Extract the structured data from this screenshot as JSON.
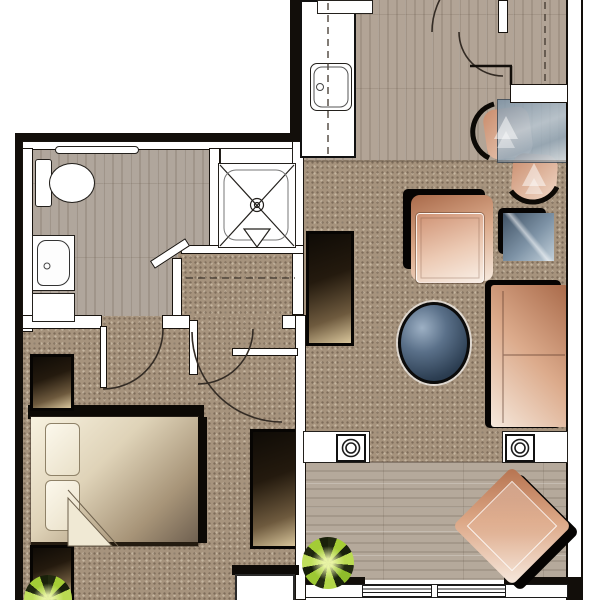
{
  "title": "One-bedroom apartment floor plan (rendered, no text labels)",
  "palette": {
    "carpet": "#a6937d",
    "wood_entry": "#b2a496",
    "wood_bathroom": "#b0a69c",
    "wood_sunroom": "#b5a99b",
    "wall_black": "#120e0a",
    "wall_white": "#ffffff",
    "upholstery_salmon_dark": "#a96a4a",
    "upholstery_salmon_light": "#f6e9dd",
    "glass_blue_dark": "#3f5164",
    "glass_blue_light": "#c2d0da",
    "coffee_table_slate": "#2c3e52",
    "bed_cream": "#f8f2e0",
    "bed_brown": "#6f6050",
    "dark_wood": "#241a0e",
    "plant_green": "#a5ce35",
    "plant_dark": "#1a230c"
  },
  "rooms": {
    "entry_kitchen": {
      "label": "Entry hall / kitchen",
      "flooring": "wood"
    },
    "dining": {
      "label": "Dining nook",
      "flooring": "wood"
    },
    "living": {
      "label": "Living room",
      "flooring": "carpet"
    },
    "bathroom": {
      "label": "Bathroom",
      "flooring": "wood"
    },
    "hall": {
      "label": "Dressing hall / closet",
      "flooring": "carpet"
    },
    "bedroom": {
      "label": "Bedroom",
      "flooring": "carpet"
    },
    "sunroom": {
      "label": "Sunroom / balcony",
      "flooring": "wood"
    }
  },
  "fixtures": {
    "toilet": {
      "label": "Toilet"
    },
    "towel_bar": {
      "label": "Towel bar"
    },
    "vanity_sink": {
      "label": "Bathroom vanity sink"
    },
    "vanity_cabinet": {
      "label": "Vanity cabinet"
    },
    "shower": {
      "label": "Shower stall with center drain"
    },
    "shower_shelf": {
      "label": "Shower shelf"
    },
    "kitchen_counter": {
      "label": "Kitchen counter with dashed centerline"
    },
    "kitchen_sink": {
      "label": "Kitchen sink"
    },
    "range": {
      "label": "Range / cooktop"
    },
    "entry_ledge": {
      "label": "Pass-through ledge over dining nook"
    },
    "window_wall": {
      "label": "Bottom window wall, two panes"
    }
  },
  "doors": {
    "entry": {
      "label": "Entry door with double swing arc"
    },
    "bathroom": {
      "label": "Bathroom door"
    },
    "bedroom": {
      "label": "Bedroom double doors, one leaf open"
    }
  },
  "furniture": {
    "bed": {
      "label": "Double bed with two pillows and turned-back blanket"
    },
    "nightstand_top": {
      "label": "Nightstand (head of bed)"
    },
    "nightstand_bottom": {
      "label": "Nightstand (foot of bed)"
    },
    "wardrobe": {
      "label": "Dresser / wardrobe"
    },
    "tv_console": {
      "label": "Media console"
    },
    "armchair": {
      "label": "Armchair"
    },
    "ottoman": {
      "label": "Ottoman"
    },
    "side_table": {
      "label": "Square glass side table"
    },
    "sofa": {
      "label": "Sofa against right wall"
    },
    "coffee_table": {
      "label": "Oval glass coffee table"
    },
    "dining_table": {
      "label": "Rectangular glass dining table"
    },
    "dining_chair_1": {
      "label": "Dining chair (left of table)"
    },
    "dining_chair_2": {
      "label": "Dining chair (below table)"
    },
    "accent_chair": {
      "label": "Accent chair rotated 45° in sunroom"
    },
    "chest": {
      "label": "Low white chest"
    },
    "planter_left": {
      "label": "Round pot on left knee-wall ledge"
    },
    "planter_right": {
      "label": "Round pot on right knee-wall ledge"
    },
    "plant_sunroom": {
      "label": "Starburst potted plant (sunroom)"
    },
    "plant_bedroom": {
      "label": "Starburst potted plant (bedroom nightstand)"
    }
  }
}
